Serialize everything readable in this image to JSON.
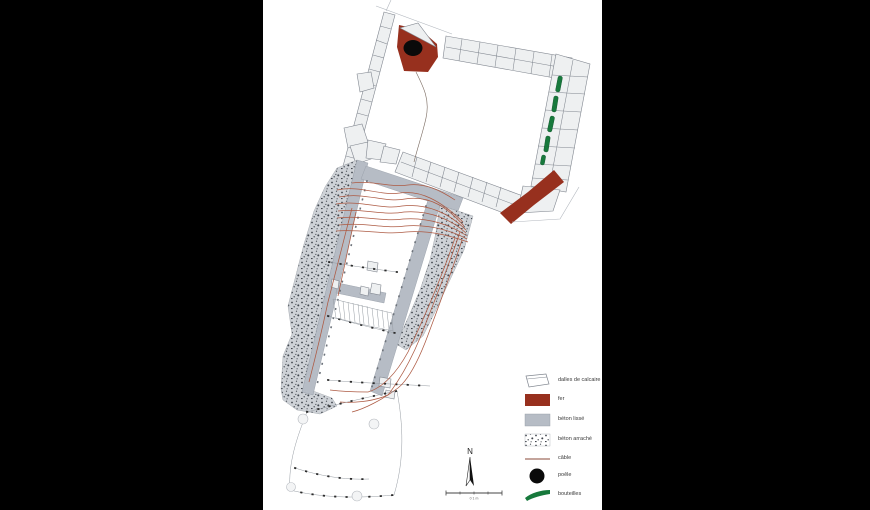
{
  "canvas": {
    "width": 870,
    "height": 510
  },
  "colors": {
    "background": "#000000",
    "panel": "#ffffff",
    "fer": "#97301e",
    "beton_lisse": "#b6bcc5",
    "beton_arrache_bg": "#ced2d7",
    "beton_arrache_dot": "#42474f",
    "limestone_fill": "#eef0f1",
    "limestone_stroke": "#80868f",
    "bottle_green": "#17793c",
    "cable": "#ad5a43",
    "poele": "#0a0a0a",
    "survey_dot": "#2c2c2c",
    "text": "#3a3a3a"
  },
  "legend": {
    "items": [
      {
        "id": "dalles-de-calcaire",
        "label": "dalles de calcaire"
      },
      {
        "id": "fer",
        "label": "fer"
      },
      {
        "id": "beton-lisse",
        "label": "béton lissé"
      },
      {
        "id": "beton-arrache",
        "label": "béton arraché"
      },
      {
        "id": "cable",
        "label": "câble"
      },
      {
        "id": "poele",
        "label": "poêle"
      },
      {
        "id": "bouteilles",
        "label": "bouteilles"
      }
    ]
  },
  "compass": {
    "label": "N"
  },
  "scale_bar": {
    "label": "0 1 m"
  }
}
